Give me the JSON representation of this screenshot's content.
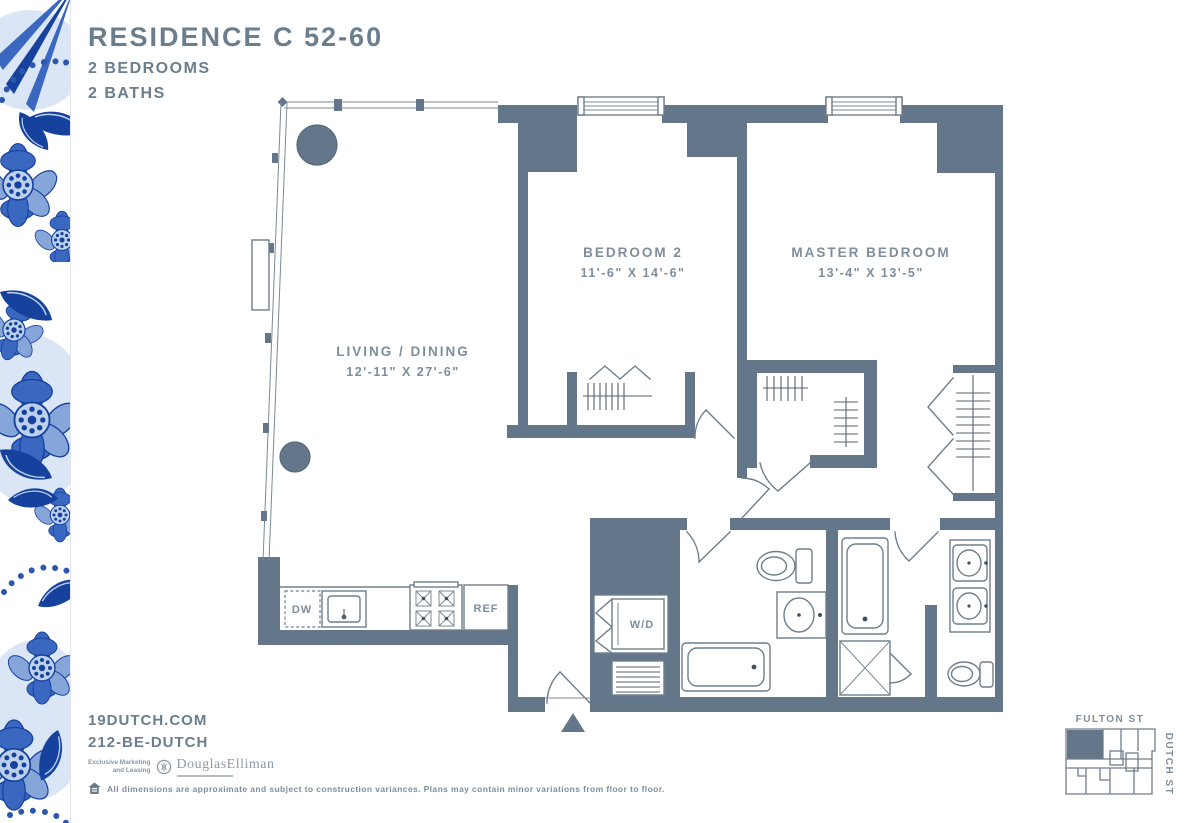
{
  "header": {
    "title": "RESIDENCE C 52-60",
    "subtitle1": "2 BEDROOMS",
    "subtitle2": "2 BATHS"
  },
  "floorplan": {
    "rooms": [
      {
        "name": "LIVING / DINING",
        "dims": "12'-11\" X 27'-6\""
      },
      {
        "name": "BEDROOM 2",
        "dims": "11'-6\" X 14'-6\""
      },
      {
        "name": "MASTER BEDROOM",
        "dims": "13'-4\" X 13'-5\""
      }
    ],
    "fixtures": {
      "dw": "DW",
      "ref": "REF",
      "wd": "W/D"
    }
  },
  "keyplan": {
    "street_top": "FULTON ST",
    "street_right": "DUTCH ST"
  },
  "footer": {
    "website": "19DUTCH.COM",
    "phone": "212-BE-DUTCH",
    "marketing_line1": "Exclusive Marketing",
    "marketing_line2": "and Leasing",
    "brand": "DouglasElliman",
    "disclaimer": "All dimensions are approximate and subject to construction variances. Plans may contain minor variations from floor to floor."
  },
  "colors": {
    "wall": "#64778A",
    "plan_line": "#6F7E8B",
    "label_text": "#7E8E9C",
    "title_text": "#6B7E8E",
    "delft_deep": "#16429E",
    "delft_mid": "#3A68C1",
    "delft_light": "#86A6DA",
    "delft_pale": "#BCD0EC"
  }
}
